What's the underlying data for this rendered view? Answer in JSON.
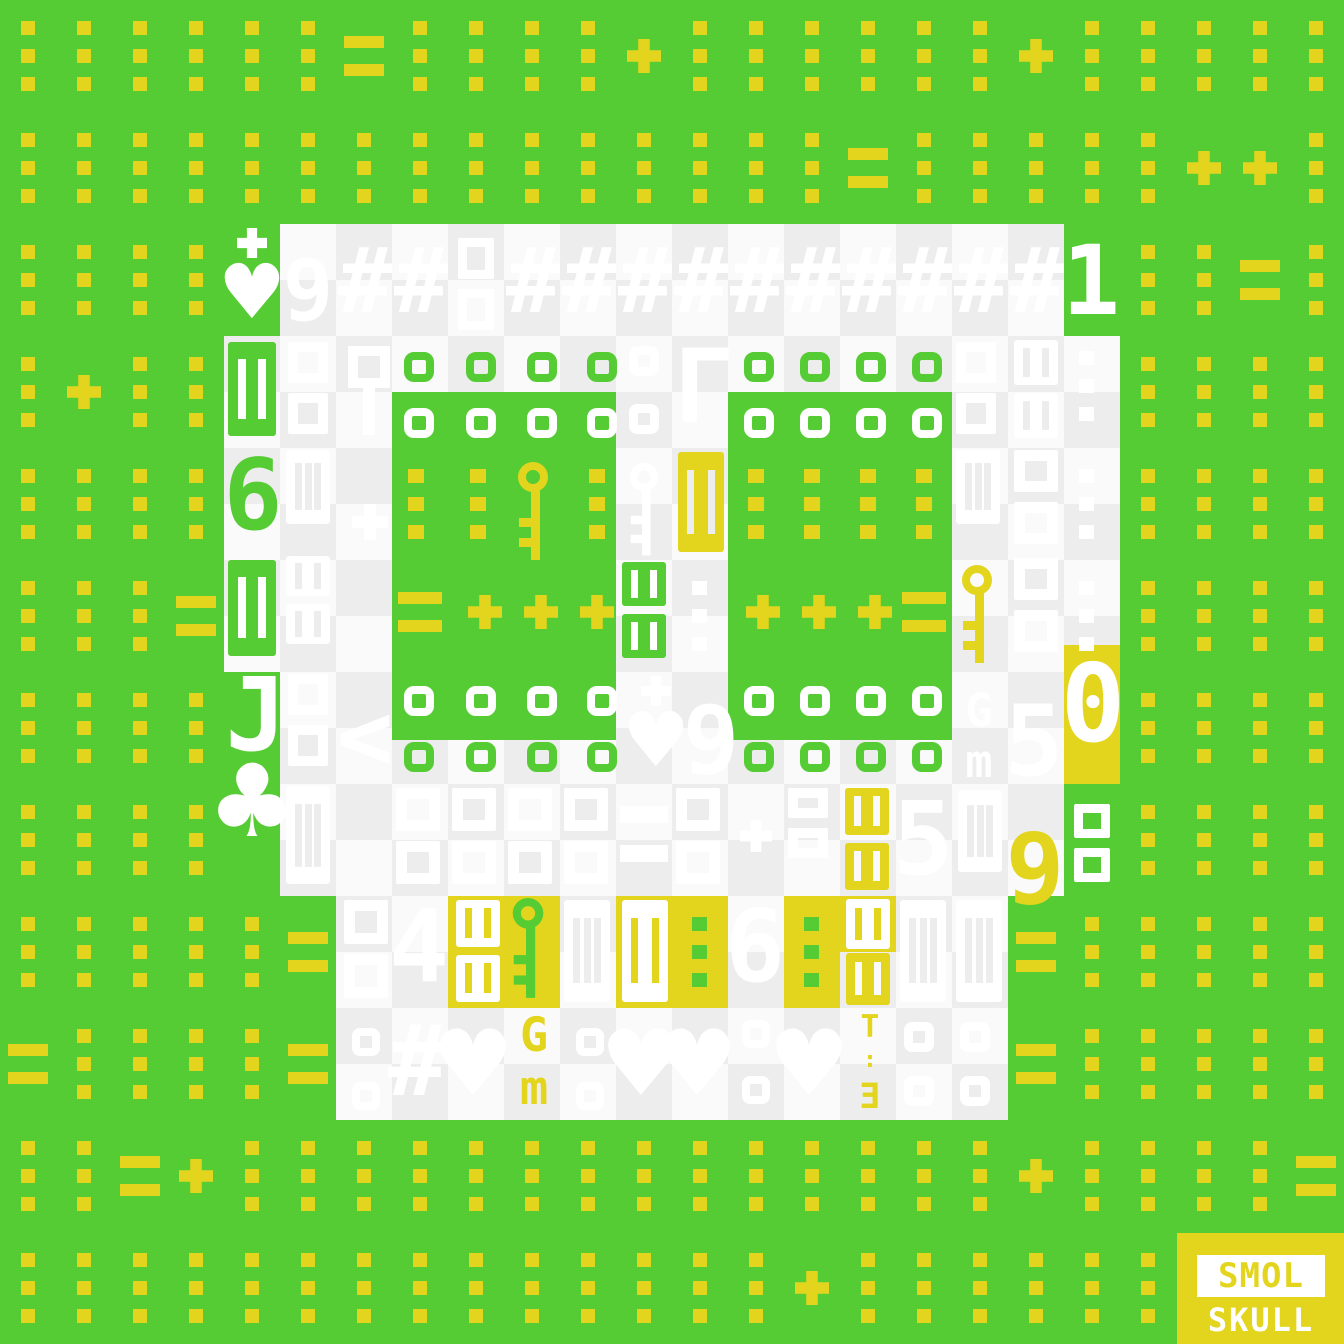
{
  "artwork": {
    "title": "SMOL SKULL",
    "width": 1344,
    "height": 1344
  },
  "palette": {
    "green": "#55CC33",
    "yellow": "#E3D51D",
    "gray": "#EDEDED",
    "bright": "#FAFAFA",
    "white": "#FFFFFF"
  },
  "background": {
    "color": "green",
    "dot_grid": {
      "color": "yellow",
      "dot_size": 14,
      "x_offset": 21,
      "col_step": 56,
      "y_offset": 21,
      "row_step": 28,
      "cols": 24,
      "row_count": 47,
      "skip_every_4th_row": true
    }
  },
  "no_dot_zones": [
    {
      "x": 224,
      "y": 224,
      "w": 896,
      "h": 672
    },
    {
      "x": 280,
      "y": 896,
      "w": 784,
      "h": 224
    },
    {
      "x": 1177,
      "y": 1233,
      "w": 167,
      "h": 111
    }
  ],
  "marks": {
    "equals_cells": [
      [
        6,
        0
      ],
      [
        15,
        1
      ],
      [
        22,
        2
      ],
      [
        3,
        5
      ],
      [
        5,
        8
      ],
      [
        18,
        8
      ],
      [
        0,
        9
      ],
      [
        5,
        9
      ],
      [
        18,
        9
      ],
      [
        2,
        10
      ],
      [
        23,
        10
      ]
    ],
    "plus_cells": [
      [
        11,
        0
      ],
      [
        18,
        0
      ],
      [
        21,
        1
      ],
      [
        22,
        1
      ],
      [
        1,
        3
      ],
      [
        3,
        10
      ],
      [
        18,
        10
      ],
      [
        14,
        11
      ]
    ],
    "cell_w": 56,
    "cell_h": 112,
    "color": "yellow"
  },
  "skull": {
    "checker_colors": [
      "bright",
      "gray"
    ],
    "rects": [
      {
        "x": 280,
        "y": 224,
        "w": 784,
        "h": 112,
        "fill": "checker"
      },
      {
        "x": 224,
        "y": 336,
        "w": 896,
        "h": 336,
        "fill": "checker"
      },
      {
        "x": 280,
        "y": 672,
        "w": 784,
        "h": 224,
        "fill": "checker"
      },
      {
        "x": 336,
        "y": 896,
        "w": 672,
        "h": 224,
        "fill": "checker"
      },
      {
        "x": 392,
        "y": 392,
        "w": 224,
        "h": 348,
        "fill": "green"
      },
      {
        "x": 728,
        "y": 392,
        "w": 224,
        "h": 348,
        "fill": "green"
      },
      {
        "x": 448,
        "y": 896,
        "w": 112,
        "h": 112,
        "fill": "yellow"
      },
      {
        "x": 616,
        "y": 896,
        "w": 112,
        "h": 112,
        "fill": "yellow"
      },
      {
        "x": 784,
        "y": 896,
        "w": 56,
        "h": 112,
        "fill": "yellow"
      },
      {
        "x": 840,
        "y": 896,
        "w": 56,
        "h": 56,
        "fill": "yellow"
      },
      {
        "x": 1064,
        "y": 645,
        "w": 56,
        "h": 139,
        "fill": "yellow"
      }
    ]
  },
  "glyphs": [
    [
      "crossheart",
      228,
      228,
      48,
      104,
      "white",
      ""
    ],
    [
      "char",
      282,
      248,
      52,
      86,
      "white",
      "9"
    ],
    [
      "char",
      338,
      236,
      54,
      92,
      "white",
      "#"
    ],
    [
      "char",
      394,
      236,
      54,
      92,
      "white",
      "#"
    ],
    [
      "boxes2",
      458,
      238,
      36,
      92,
      "white",
      ""
    ],
    [
      "char",
      506,
      236,
      54,
      92,
      "white",
      "#"
    ],
    [
      "char",
      562,
      236,
      54,
      92,
      "white",
      "#"
    ],
    [
      "char",
      618,
      236,
      54,
      92,
      "white",
      "#"
    ],
    [
      "char",
      674,
      236,
      54,
      92,
      "white",
      "#"
    ],
    [
      "char",
      730,
      236,
      54,
      92,
      "white",
      "#"
    ],
    [
      "char",
      786,
      236,
      54,
      92,
      "white",
      "#"
    ],
    [
      "char",
      842,
      236,
      54,
      92,
      "white",
      "#"
    ],
    [
      "char",
      898,
      236,
      54,
      92,
      "white",
      "#"
    ],
    [
      "char",
      954,
      236,
      54,
      92,
      "white",
      "#"
    ],
    [
      "char",
      1010,
      236,
      54,
      92,
      "white",
      "#"
    ],
    [
      "char",
      1066,
      232,
      50,
      98,
      "white",
      "1"
    ],
    [
      "bbox",
      228,
      342,
      48,
      94,
      "green",
      "white"
    ],
    [
      "boxes2",
      288,
      342,
      40,
      92,
      "white",
      ""
    ],
    [
      "boxstem",
      348,
      346,
      42,
      94,
      "white",
      ""
    ],
    [
      "ring",
      404,
      352,
      30,
      30,
      "green",
      ""
    ],
    [
      "ring",
      466,
      352,
      30,
      30,
      "green",
      ""
    ],
    [
      "ring",
      527,
      352,
      30,
      30,
      "green",
      ""
    ],
    [
      "ring",
      587,
      352,
      30,
      30,
      "green",
      ""
    ],
    [
      "ring",
      744,
      352,
      30,
      30,
      "green",
      ""
    ],
    [
      "ring",
      800,
      352,
      30,
      30,
      "green",
      ""
    ],
    [
      "ring",
      856,
      352,
      30,
      30,
      "green",
      ""
    ],
    [
      "ring",
      912,
      352,
      30,
      30,
      "green",
      ""
    ],
    [
      "rings2",
      629,
      346,
      30,
      88,
      "white",
      ""
    ],
    [
      "char",
      684,
      336,
      40,
      104,
      "white",
      "Γ"
    ],
    [
      "boxes2",
      956,
      342,
      40,
      92,
      "white",
      ""
    ],
    [
      "tenbox",
      1014,
      340,
      44,
      98,
      "white",
      "gray"
    ],
    [
      "dots3",
      1079,
      351,
      15,
      70,
      "white",
      ""
    ],
    [
      "ring",
      404,
      408,
      30,
      30,
      "white",
      ""
    ],
    [
      "ring",
      466,
      408,
      30,
      30,
      "white",
      ""
    ],
    [
      "ring",
      527,
      408,
      30,
      30,
      "white",
      ""
    ],
    [
      "ring",
      587,
      408,
      30,
      30,
      "white",
      ""
    ],
    [
      "ring",
      744,
      408,
      30,
      30,
      "white",
      ""
    ],
    [
      "ring",
      800,
      408,
      30,
      30,
      "white",
      ""
    ],
    [
      "ring",
      856,
      408,
      30,
      30,
      "white",
      ""
    ],
    [
      "ring",
      912,
      408,
      30,
      30,
      "white",
      ""
    ],
    [
      "char",
      226,
      446,
      54,
      100,
      "green",
      "6"
    ],
    [
      "iiibox",
      286,
      450,
      44,
      74,
      "white",
      "gray"
    ],
    [
      "plus",
      352,
      504,
      36,
      36,
      "white",
      ""
    ],
    [
      "dots3",
      408,
      469,
      16,
      70,
      "yellow",
      ""
    ],
    [
      "dots3",
      470,
      469,
      16,
      70,
      "yellow",
      ""
    ],
    [
      "key",
      514,
      462,
      36,
      104,
      "yellow",
      ""
    ],
    [
      "dots3",
      589,
      469,
      16,
      70,
      "yellow",
      ""
    ],
    [
      "dots3",
      748,
      469,
      16,
      70,
      "yellow",
      ""
    ],
    [
      "dots3",
      804,
      469,
      16,
      70,
      "yellow",
      ""
    ],
    [
      "dots3",
      860,
      469,
      16,
      70,
      "yellow",
      ""
    ],
    [
      "dots3",
      916,
      469,
      16,
      70,
      "yellow",
      ""
    ],
    [
      "key",
      626,
      462,
      34,
      100,
      "white",
      ""
    ],
    [
      "bbox",
      678,
      452,
      46,
      100,
      "yellow",
      "gray"
    ],
    [
      "iiibox",
      956,
      450,
      44,
      74,
      "white",
      "gray"
    ],
    [
      "boxes2",
      1014,
      450,
      44,
      94,
      "white",
      ""
    ],
    [
      "dots3",
      1079,
      469,
      15,
      70,
      "white",
      ""
    ],
    [
      "bbox",
      228,
      560,
      48,
      96,
      "green",
      "white"
    ],
    [
      "tenbox",
      286,
      556,
      44,
      88,
      "white",
      "gray"
    ],
    [
      "equals",
      398,
      592,
      44,
      40,
      "yellow",
      ""
    ],
    [
      "plus",
      468,
      595,
      34,
      34,
      "yellow",
      ""
    ],
    [
      "plus",
      524,
      595,
      34,
      34,
      "yellow",
      ""
    ],
    [
      "plus",
      580,
      595,
      34,
      34,
      "yellow",
      ""
    ],
    [
      "plus",
      746,
      595,
      34,
      34,
      "yellow",
      ""
    ],
    [
      "plus",
      802,
      595,
      34,
      34,
      "yellow",
      ""
    ],
    [
      "plus",
      858,
      595,
      34,
      34,
      "yellow",
      ""
    ],
    [
      "equals",
      902,
      592,
      44,
      40,
      "yellow",
      ""
    ],
    [
      "tenbox",
      622,
      562,
      44,
      96,
      "green",
      "white"
    ],
    [
      "dots3",
      692,
      581,
      15,
      70,
      "white",
      ""
    ],
    [
      "key",
      958,
      564,
      36,
      106,
      "yellow",
      ""
    ],
    [
      "boxes2",
      1014,
      558,
      44,
      94,
      "white",
      ""
    ],
    [
      "dots3",
      1079,
      581,
      15,
      70,
      "white",
      ""
    ],
    [
      "char",
      232,
      664,
      48,
      104,
      "white",
      "J"
    ],
    [
      "boxes2",
      288,
      674,
      40,
      92,
      "white",
      ""
    ],
    [
      "char",
      340,
      690,
      50,
      96,
      "white",
      "<"
    ],
    [
      "ring",
      404,
      686,
      30,
      30,
      "white",
      ""
    ],
    [
      "ring",
      466,
      686,
      30,
      30,
      "white",
      ""
    ],
    [
      "ring",
      527,
      686,
      30,
      30,
      "white",
      ""
    ],
    [
      "ring",
      587,
      686,
      30,
      30,
      "white",
      ""
    ],
    [
      "ring",
      744,
      686,
      30,
      30,
      "white",
      ""
    ],
    [
      "ring",
      800,
      686,
      30,
      30,
      "white",
      ""
    ],
    [
      "ring",
      856,
      686,
      30,
      30,
      "white",
      ""
    ],
    [
      "ring",
      912,
      686,
      30,
      30,
      "white",
      ""
    ],
    [
      "ring",
      404,
      742,
      30,
      30,
      "green",
      ""
    ],
    [
      "ring",
      466,
      742,
      30,
      30,
      "green",
      ""
    ],
    [
      "ring",
      527,
      742,
      30,
      30,
      "green",
      ""
    ],
    [
      "ring",
      587,
      742,
      30,
      30,
      "green",
      ""
    ],
    [
      "ring",
      744,
      742,
      30,
      30,
      "green",
      ""
    ],
    [
      "ring",
      800,
      742,
      30,
      30,
      "green",
      ""
    ],
    [
      "ring",
      856,
      742,
      30,
      30,
      "green",
      ""
    ],
    [
      "ring",
      912,
      742,
      30,
      30,
      "green",
      ""
    ],
    [
      "crossheart",
      632,
      676,
      48,
      104,
      "white",
      ""
    ],
    [
      "char",
      686,
      694,
      50,
      96,
      "white",
      "9"
    ],
    [
      "gm",
      958,
      688,
      42,
      102,
      "white",
      ""
    ],
    [
      "char",
      1008,
      692,
      52,
      100,
      "white",
      "5"
    ],
    [
      "char",
      1068,
      650,
      50,
      110,
      "white",
      "0"
    ],
    [
      "char",
      224,
      750,
      56,
      104,
      "white",
      "♣"
    ],
    [
      "iiibox",
      286,
      786,
      44,
      98,
      "white",
      "gray"
    ],
    [
      "eight8",
      396,
      788,
      44,
      96,
      "white",
      ""
    ],
    [
      "eight8",
      452,
      788,
      44,
      96,
      "white",
      ""
    ],
    [
      "eight8",
      508,
      788,
      44,
      96,
      "white",
      ""
    ],
    [
      "eight8",
      564,
      788,
      44,
      96,
      "white",
      ""
    ],
    [
      "equals",
      620,
      806,
      48,
      56,
      "white",
      ""
    ],
    [
      "eight8",
      676,
      788,
      44,
      96,
      "white",
      ""
    ],
    [
      "plus",
      740,
      820,
      32,
      32,
      "white",
      ""
    ],
    [
      "eight8",
      788,
      788,
      40,
      70,
      "white",
      ""
    ],
    [
      "tenbox",
      845,
      788,
      44,
      102,
      "yellow",
      "bright"
    ],
    [
      "char",
      896,
      788,
      54,
      104,
      "white",
      "5"
    ],
    [
      "iiibox",
      958,
      790,
      44,
      82,
      "white",
      "gray"
    ],
    [
      "char",
      1010,
      820,
      50,
      100,
      "yellow",
      "9"
    ],
    [
      "eight8",
      1074,
      804,
      36,
      78,
      "white",
      ""
    ],
    [
      "boxes2",
      344,
      900,
      44,
      98,
      "white",
      ""
    ],
    [
      "char",
      392,
      896,
      54,
      102,
      "white",
      "4"
    ],
    [
      "tenbox",
      456,
      900,
      44,
      102,
      "white",
      "yellow"
    ],
    [
      "key",
      508,
      898,
      38,
      106,
      "green",
      ""
    ],
    [
      "iiibox",
      564,
      900,
      46,
      102,
      "white",
      "gray"
    ],
    [
      "bbox",
      622,
      900,
      46,
      102,
      "white",
      "yellow"
    ],
    [
      "dots3",
      692,
      917,
      15,
      70,
      "green",
      ""
    ],
    [
      "char",
      728,
      896,
      54,
      102,
      "white",
      "6"
    ],
    [
      "dots3",
      804,
      917,
      15,
      70,
      "green",
      ""
    ],
    [
      "tenbox1",
      846,
      899,
      44,
      50,
      "white",
      "yellow"
    ],
    [
      "tenbox1",
      846,
      953,
      44,
      52,
      "yellow",
      "bright"
    ],
    [
      "iiibox",
      900,
      900,
      46,
      102,
      "white",
      "gray"
    ],
    [
      "iiibox",
      956,
      900,
      46,
      102,
      "white",
      "gray"
    ],
    [
      "rings2",
      352,
      1028,
      28,
      82,
      "white",
      ""
    ],
    [
      "char",
      390,
      1012,
      54,
      100,
      "white",
      "#"
    ],
    [
      "char",
      444,
      1018,
      58,
      94,
      "white",
      "♥"
    ],
    [
      "gm",
      512,
      1012,
      44,
      106,
      "yellow",
      ""
    ],
    [
      "rings2",
      576,
      1028,
      28,
      82,
      "white",
      ""
    ],
    [
      "char",
      612,
      1018,
      58,
      94,
      "white",
      "♥"
    ],
    [
      "char",
      668,
      1018,
      58,
      94,
      "white",
      "♥"
    ],
    [
      "rings2",
      742,
      1020,
      28,
      84,
      "white",
      ""
    ],
    [
      "char",
      780,
      1018,
      58,
      94,
      "white",
      "♥"
    ],
    [
      "e3",
      850,
      1012,
      40,
      108,
      "yellow",
      ""
    ],
    [
      "rings2",
      904,
      1022,
      30,
      84,
      "white",
      ""
    ],
    [
      "rings2",
      960,
      1022,
      30,
      84,
      "white",
      ""
    ]
  ],
  "logo": {
    "x": 1177,
    "y": 1233,
    "w": 167,
    "h": 111,
    "bg": "yellow",
    "line1": {
      "text": "SMOL",
      "fg": "yellow",
      "band": "white",
      "x": 20,
      "y": 22,
      "w": 128,
      "h": 42,
      "font_size": 34
    },
    "line2": {
      "text": "SKULL",
      "fg": "white",
      "x": 18,
      "y": 68,
      "w": 132,
      "h": 38,
      "font_size": 32
    }
  }
}
